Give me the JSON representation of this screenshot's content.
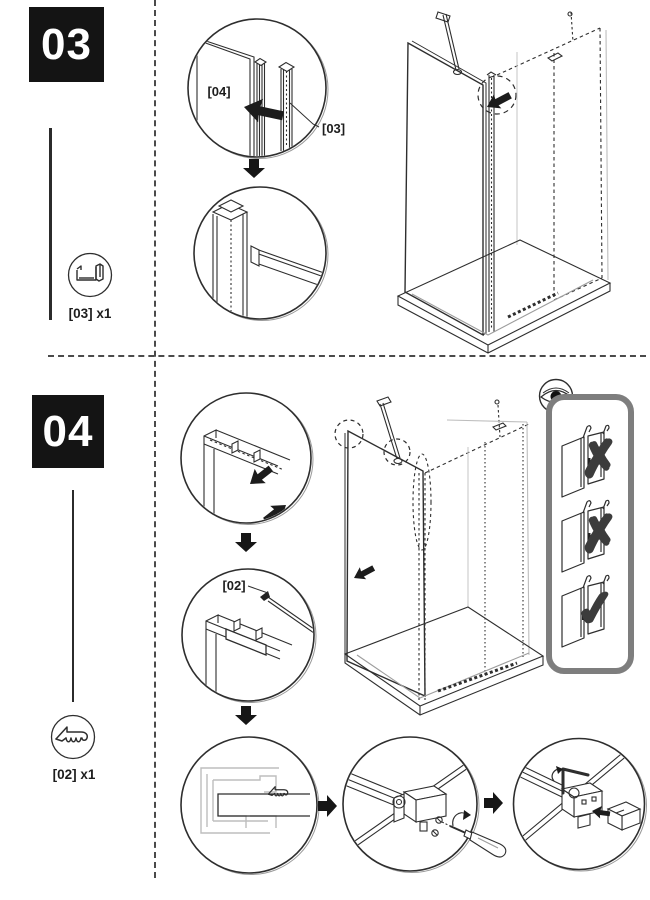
{
  "step03": {
    "badge": "03",
    "part_label": "[03] x1",
    "part_icon": "u-channel-profile-icon",
    "detail1": {
      "glass_label": "[04]",
      "profile_label": "[03]"
    }
  },
  "step04": {
    "badge": "04",
    "part_label": "[02] x1",
    "part_icon": "rubber-seal-profile-icon",
    "detail2": {
      "seal_label": "[02]"
    }
  },
  "checks": {
    "icon": "eye-icon",
    "marks": [
      {
        "symbol": "✗",
        "meaning": "wrong"
      },
      {
        "symbol": "✗",
        "meaning": "wrong"
      },
      {
        "symbol": "✓",
        "meaning": "correct"
      }
    ]
  },
  "colors": {
    "ink": "#2e2e2e",
    "light_line": "#bdbdbd",
    "badge_bg": "#141414",
    "badge_text": "#ffffff",
    "panel_border": "#7e7e7e",
    "mark": "#3c3c3c",
    "arrow_fill": "#161616"
  }
}
